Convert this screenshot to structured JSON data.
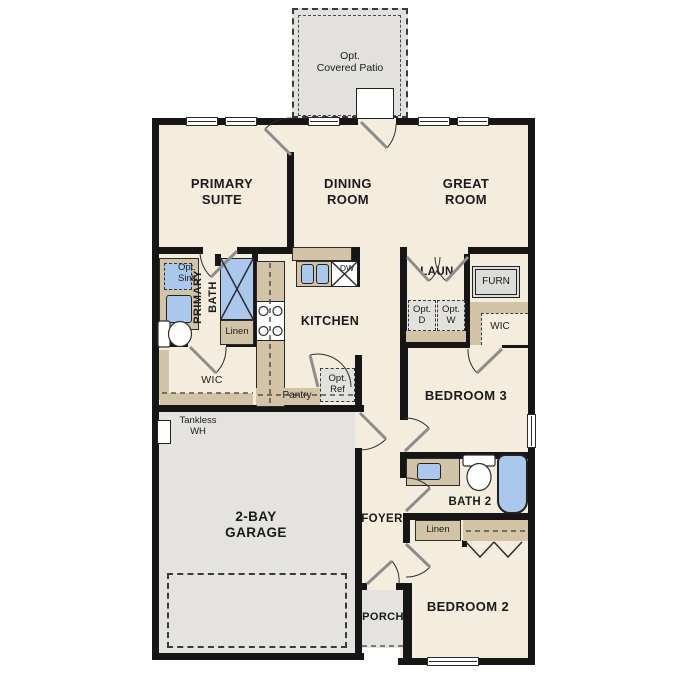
{
  "meta": {
    "type": "single-story floor plan"
  },
  "colors": {
    "floor": "#f4eddd",
    "outdoor_concrete": "#e4e3e0",
    "wall": "#161616",
    "counter_tan": "#d3c4a7",
    "fixture_blue": "#a9c8eb"
  },
  "rooms": {
    "patio": "Opt.\nCovered Patio",
    "primary_suite": "PRIMARY\nSUITE",
    "dining_room": "DINING\nROOM",
    "great_room": "GREAT\nROOM",
    "kitchen": "KITCHEN",
    "laundry": "LAUN",
    "primary_bath": "PRIMARY\nBATH",
    "wic_primary": "WIC",
    "wic_bed3": "WIC",
    "bedroom3": "BEDROOM 3",
    "bath2": "BATH 2",
    "bedroom2": "BEDROOM 2",
    "foyer": "FOYER",
    "porch": "PORCH",
    "garage": "2-BAY\nGARAGE",
    "pantry": "Pantry"
  },
  "fixtures": {
    "furnace": "FURN",
    "dishwasher": "DW",
    "opt_dryer": "Opt.\nD",
    "opt_washer": "Opt.\nW",
    "opt_ref": "Opt.\nRef",
    "opt_sink": "Opt.\nSink",
    "linen_primary": "Linen",
    "linen_hall": "Linen",
    "tankless_wh": "Tankless\nWH"
  }
}
